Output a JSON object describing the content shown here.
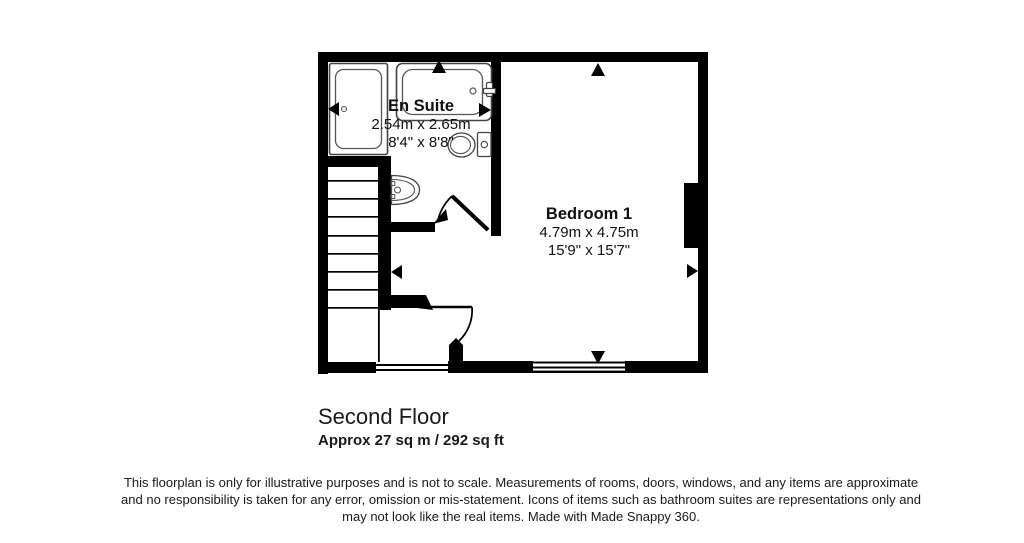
{
  "colors": {
    "wall": "#000000",
    "fixture_outline": "#555555",
    "text": "#1a1a1a",
    "background": "#ffffff"
  },
  "floorplan": {
    "rooms": [
      {
        "name": "En Suite",
        "dimensions_metric": "2.54m x 2.65m",
        "dimensions_imperial": "8'4\" x 8'8\""
      },
      {
        "name": "Bedroom 1",
        "dimensions_metric": "4.79m x 4.75m",
        "dimensions_imperial": "15'9\" x 15'7\""
      }
    ],
    "icons": [
      "shower-tray-icon",
      "bathtub-icon",
      "toilet-icon",
      "wash-basin-icon",
      "staircase-icon",
      "door-swing-icon",
      "window-icon",
      "measurement-arrow-icon"
    ]
  },
  "footer": {
    "floor_label": "Second Floor",
    "area_label": "Approx 27 sq m / 292 sq ft",
    "disclaimer_lines": [
      "This floorplan is only for illustrative purposes and is not to scale. Measurements of rooms, doors, windows, and any items are approximate",
      "and no responsibility is taken for any error, omission or mis-statement. Icons of items such as bathroom suites are representations only and",
      "may not look like the real items. Made with Made Snappy 360."
    ]
  }
}
